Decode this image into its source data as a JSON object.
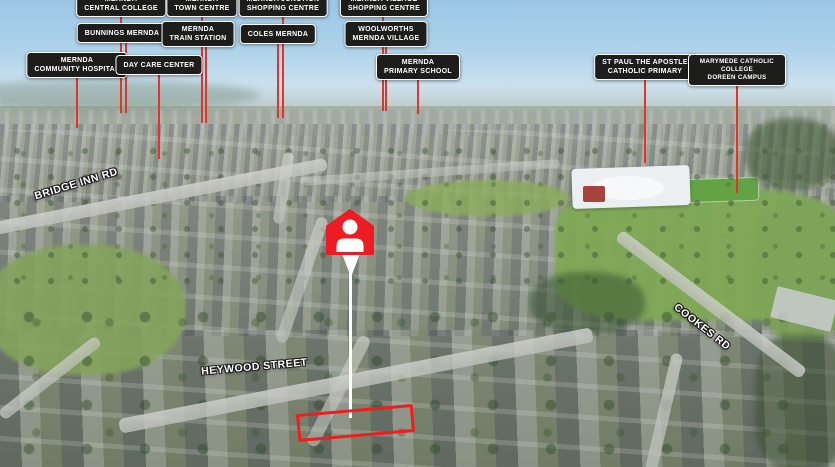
{
  "map_overlay": {
    "amenity_labels": [
      {
        "id": "mernda-central-college",
        "text": "MERNDA\nCENTRAL COLLEGE"
      },
      {
        "id": "mernda-town-centre",
        "text": "MERNDA\nTOWN CENTRE"
      },
      {
        "id": "mernda-junction-shopping",
        "text": "MERNDA JUNCTION\nSHOPPING CENTRE"
      },
      {
        "id": "mernda-village-shopping",
        "text": "MERNDA VILLAGE\nSHOPPING CENTRE"
      },
      {
        "id": "bunnings-mernda",
        "text": "BUNNINGS MERNDA"
      },
      {
        "id": "mernda-train-station",
        "text": "MERNDA\nTRAIN STATION"
      },
      {
        "id": "coles-mernda",
        "text": "COLES MERNDA"
      },
      {
        "id": "woolworths-mernda",
        "text": "WOOLWORTHS\nMERNDA VILLAGE"
      },
      {
        "id": "mernda-community-hospital",
        "text": "MERNDA\nCOMMUNITY HOSPITAL"
      },
      {
        "id": "day-care-center",
        "text": "DAY CARE CENTER"
      },
      {
        "id": "mernda-primary-school",
        "text": "MERNDA\nPRIMARY SCHOOL"
      },
      {
        "id": "st-paul-apostle-primary",
        "text": "ST PAUL THE APOSTLE\nCATHOLIC PRIMARY"
      },
      {
        "id": "marymede-doreen-campus",
        "text": "MARYMEDE CATHOLIC COLLEGE\nDOREEN CAMPUS"
      }
    ],
    "street_labels": [
      {
        "id": "bridge-inn-rd",
        "name": "BRIDGE INN RD"
      },
      {
        "id": "heywood-street",
        "name": "HEYWOOD STREET"
      },
      {
        "id": "cookes-rd",
        "name": "COOKES RD"
      }
    ],
    "colors": {
      "badge_background": "#1d1d1b",
      "badge_border": "#ffffff",
      "badge_text": "#ffffff",
      "pointer_line_red": "#e2342b",
      "pin_red": "#ed1c24",
      "pin_glyph": "#ffffff",
      "highlight_box_red": "#ef1d1d",
      "street_text": "#ffffff"
    }
  }
}
